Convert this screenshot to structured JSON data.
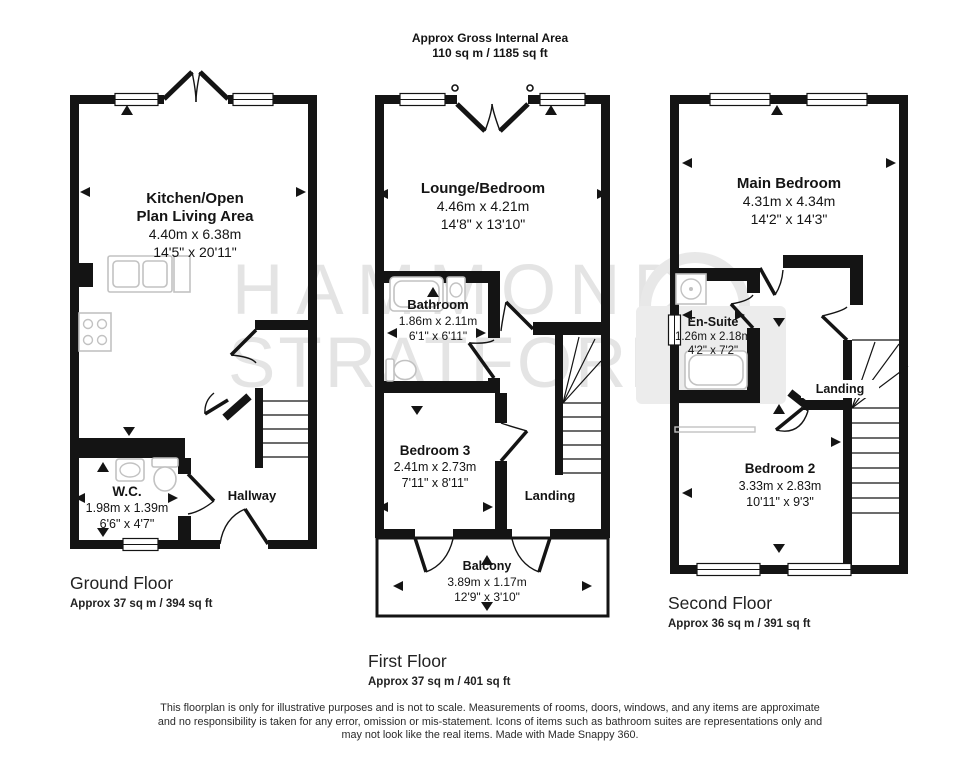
{
  "title": {
    "line1": "Approx Gross Internal Area",
    "line2": "110 sq m / 1185 sq ft"
  },
  "watermark": {
    "line1": "HAMMOND",
    "line2": "STRATFORD"
  },
  "colors": {
    "wall": "#141414",
    "fixture": "#c2c2c2",
    "watermark": "#e4e4e4"
  },
  "floors": {
    "ground": {
      "name": "Ground Floor",
      "area": "Approx 37 sq m / 394 sq ft",
      "rooms": {
        "kitchen": {
          "name1": "Kitchen/Open",
          "name2": "Plan Living Area",
          "metric": "4.40m x 6.38m",
          "imperial": "14'5\" x 20'11\""
        },
        "wc": {
          "name": "W.C.",
          "metric": "1.98m x 1.39m",
          "imperial": "6'6\" x 4'7\""
        },
        "hallway": {
          "name": "Hallway"
        }
      }
    },
    "first": {
      "name": "First Floor",
      "area": "Approx 37 sq m / 401 sq ft",
      "rooms": {
        "lounge": {
          "name": "Lounge/Bedroom",
          "metric": "4.46m x 4.21m",
          "imperial": "14'8\" x 13'10\""
        },
        "bathroom": {
          "name": "Bathroom",
          "metric": "1.86m x 2.11m",
          "imperial": "6'1\" x 6'11\""
        },
        "bedroom3": {
          "name": "Bedroom 3",
          "metric": "2.41m x 2.73m",
          "imperial": "7'11\" x 8'11\""
        },
        "landing": {
          "name": "Landing"
        },
        "balcony": {
          "name": "Balcony",
          "metric": "3.89m x 1.17m",
          "imperial": "12'9\" x 3'10\""
        }
      }
    },
    "second": {
      "name": "Second Floor",
      "area": "Approx 36 sq m / 391 sq ft",
      "rooms": {
        "main_bedroom": {
          "name": "Main Bedroom",
          "metric": "4.31m x 4.34m",
          "imperial": "14'2\" x 14'3\""
        },
        "ensuite": {
          "name": "En-Suite",
          "metric": "1.26m x 2.18m",
          "imperial": "4'2\" x 7'2\""
        },
        "landing": {
          "name": "Landing"
        },
        "bedroom2": {
          "name": "Bedroom 2",
          "metric": "3.33m x 2.83m",
          "imperial": "10'11\" x 9'3\""
        }
      }
    }
  },
  "disclaimer": {
    "line1": "This floorplan is only for illustrative purposes and is not to scale. Measurements of rooms, doors, windows, and any items are approximate",
    "line2": "and no responsibility is taken for any error, omission or mis-statement. Icons of items such as bathroom suites are representations only and",
    "line3": "may not look like the real items. Made with Made Snappy 360."
  }
}
